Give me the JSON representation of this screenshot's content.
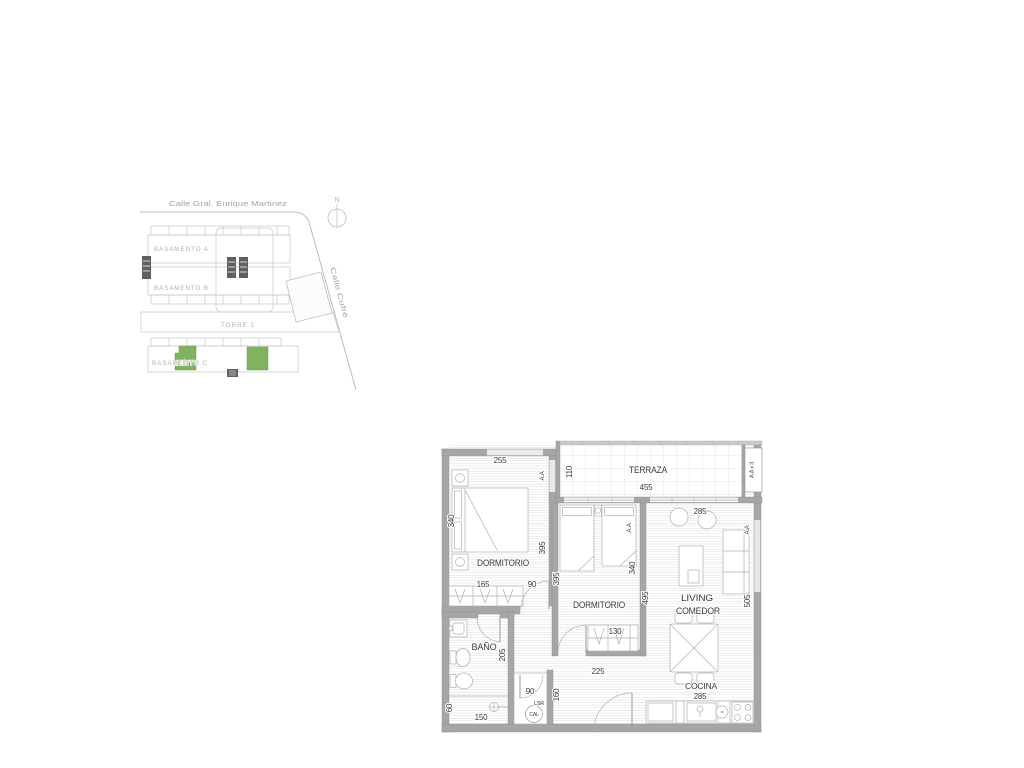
{
  "site_plan": {
    "street_top": "Calle Gral. Enrique Martinez",
    "street_side": "Calle Cufré",
    "north": "N",
    "basamento_a": "BASAMENTO A",
    "basamento_b": "BASAMENTO B",
    "torre": "TORRE 1",
    "basamento_c": "BASAMENTO C",
    "highlight_color": "#7fb35f"
  },
  "floor_plan": {
    "wall_color": "#a6a6a6",
    "rooms": {
      "terraza": "TERRAZA",
      "dormitorio_1": "DORMITORIO",
      "dormitorio_2": "DORMITORIO",
      "living_line1": "LIVING",
      "living_line2": "COMEDOR",
      "bano": "BAÑO",
      "cocina": "COCINA"
    },
    "equipment": {
      "aa_dorm1": "A.A",
      "aa_dorm2": "A.A",
      "aa_living": "A.A",
      "aa_x3": "A.A x 3",
      "lsr": "LSR",
      "cal": "CAL"
    },
    "dimensions": {
      "dorm1_width": "255",
      "dorm1_height": "340",
      "dorm1_wall_right": "395",
      "closet1_width": "165",
      "door1_width": "90",
      "terraza_depth": "110",
      "terraza_width": "455",
      "dorm2_left": "395",
      "dorm2_right": "340",
      "closet2_width": "130",
      "dorm2_width": "225",
      "living_width": "285",
      "living_left": "495",
      "living_right": "505",
      "bano_depth": "205",
      "bano_width": "150",
      "shower_width": "60",
      "lsr_width": "90",
      "hall_depth": "160",
      "cocina_width": "285"
    }
  }
}
